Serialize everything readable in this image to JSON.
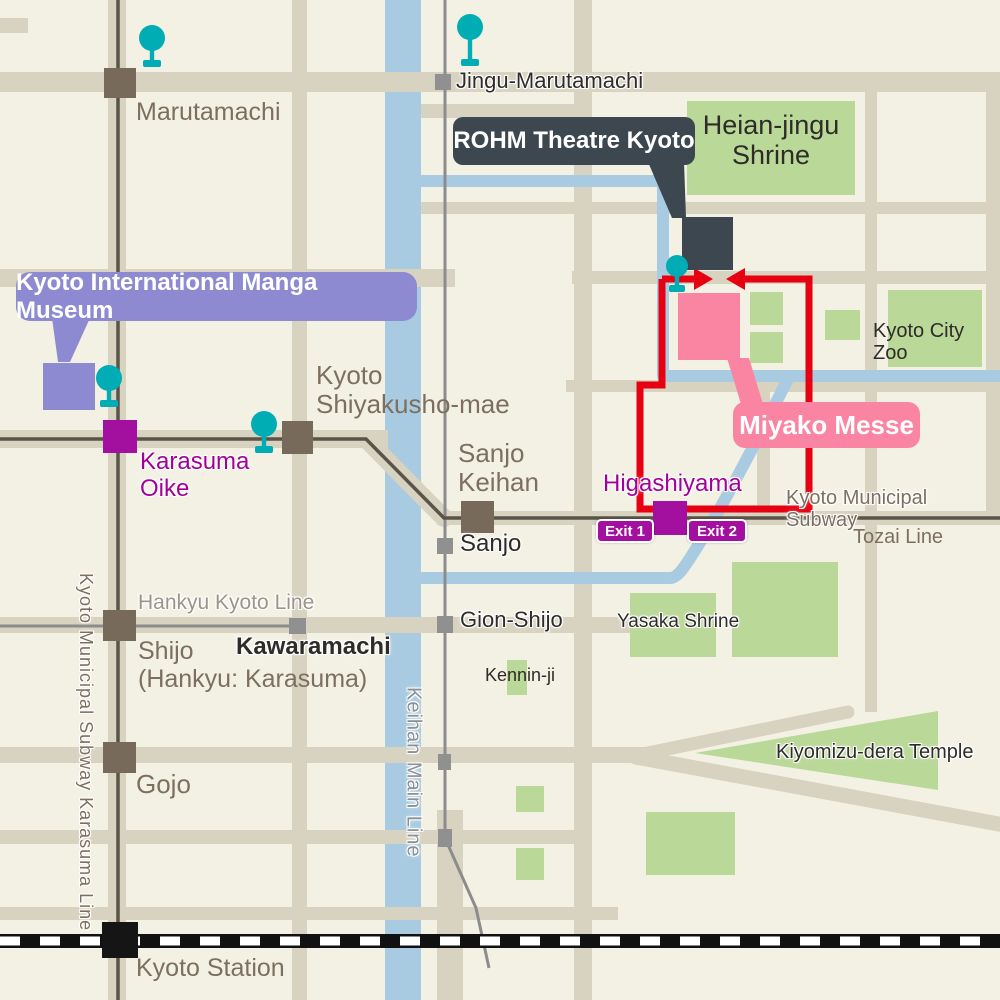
{
  "badges": {
    "rohm": "ROHM Theatre Kyoto",
    "manga": "Kyoto International Manga Museum",
    "miyako": "Miyako Messe"
  },
  "stations": {
    "marutamachi": "Marutamachi",
    "jingu_marutamachi": "Jingu-Marutamachi",
    "karasuma_oike": "Karasuma\nOike",
    "shiyakusho": "Kyoto\nShiyakusho-mae",
    "sanjo_keihan": "Sanjo\nKeihan",
    "sanjo": "Sanjo",
    "gion_shijo": "Gion-Shijo",
    "higashiyama": "Higashiyama",
    "kawaramachi": "Kawaramachi",
    "shijo": "Shijo\n(Hankyu: Karasuma)",
    "gojo": "Gojo",
    "kyoto_station": "Kyoto Station"
  },
  "exits": {
    "exit1": "Exit 1",
    "exit2": "Exit 2"
  },
  "places": {
    "heian": "Heian-jingu\nShrine",
    "zoo": "Kyoto City Zoo",
    "yasaka": "Yasaka Shrine",
    "kenninji": "Kennin-ji",
    "kiyomizu": "Kiyomizu-dera Temple"
  },
  "lines": {
    "subway_tozai_1": "Kyoto Municipal Subway",
    "subway_tozai_2": "Tozai Line",
    "karasuma_line": "Kyoto Municipal Subway Karasuma Line",
    "keihan_main": "Keihan Main Line",
    "hankyu": "Hankyu Kyoto Line"
  },
  "colors": {
    "background": "#f3f1e4",
    "road_tan": "#d8d2c0",
    "water_blue": "#a9cbe1",
    "park_green": "#bad898",
    "route_red": "#e60012",
    "pin_teal": "#00adb4",
    "station_magenta": "#a310a0",
    "badge_purple": "#8e8ad2",
    "badge_pink": "#fa85a3",
    "badge_dark": "#3c4750",
    "station_brown": "#786a5a"
  }
}
